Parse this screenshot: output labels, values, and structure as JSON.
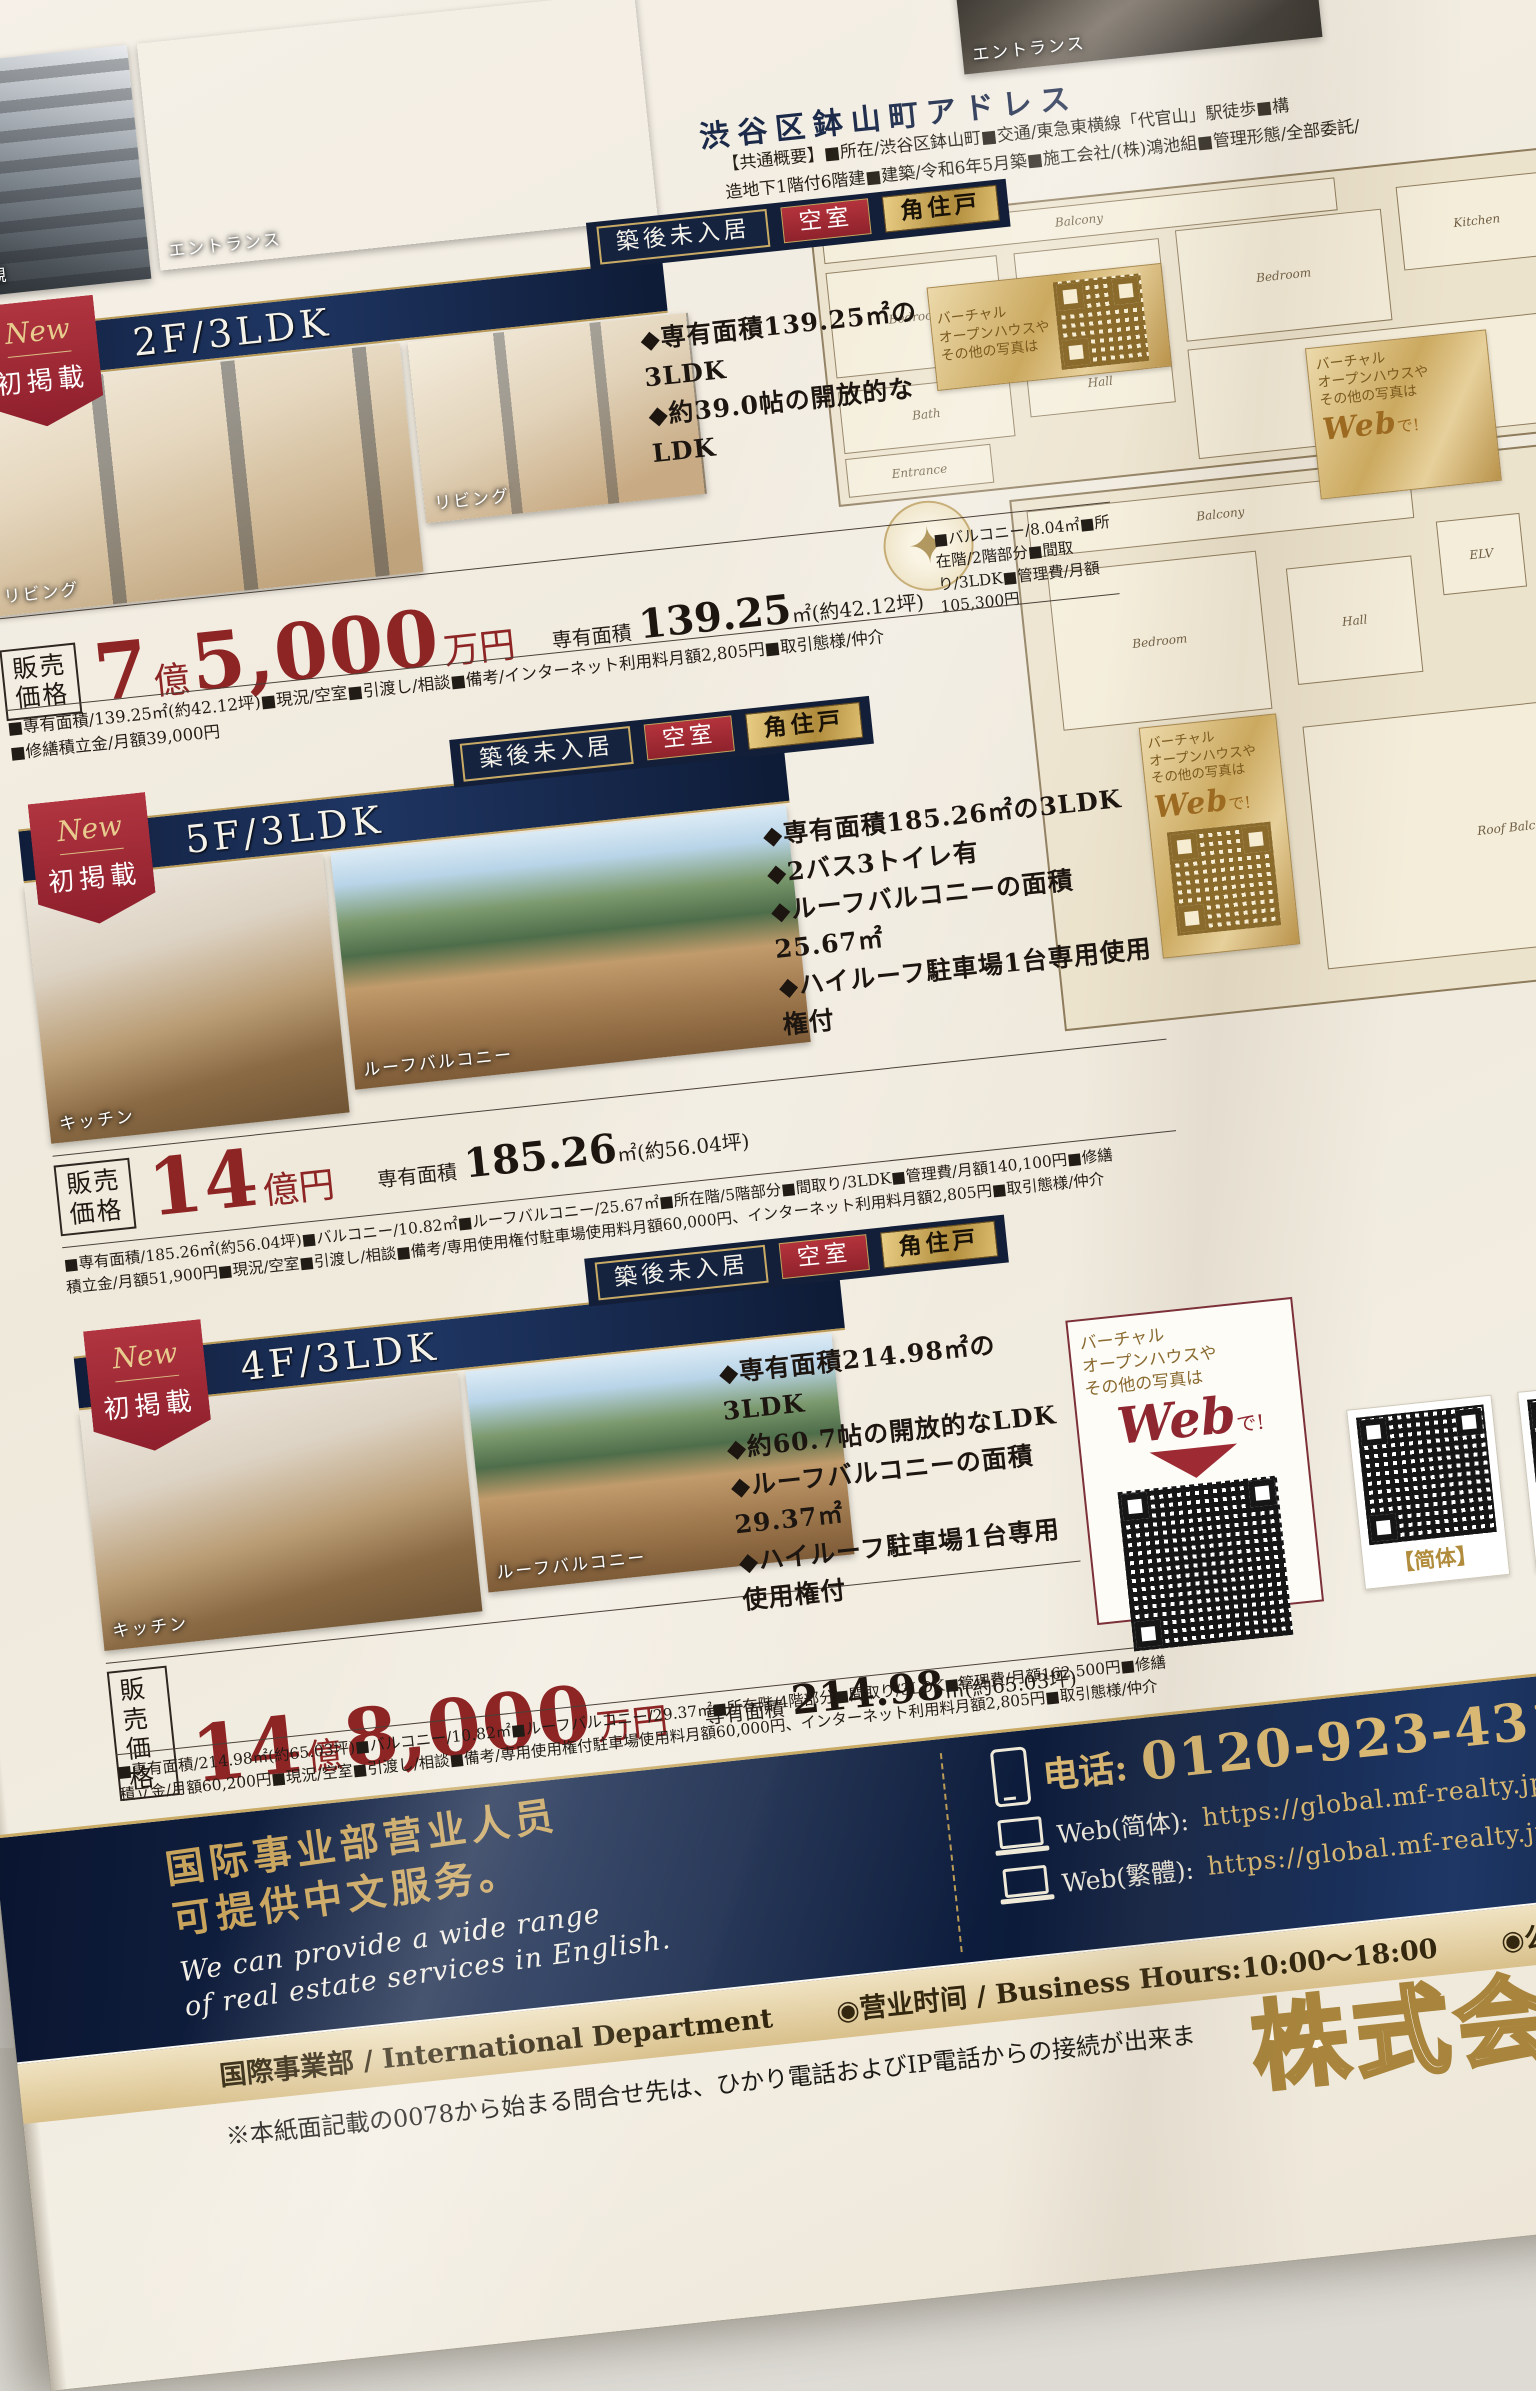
{
  "top_photos": {
    "labels": [
      "外観",
      "エントランス",
      "エントランス"
    ]
  },
  "badges": {
    "built": "築後未入居",
    "vacant": "空室",
    "corner": "角住戸"
  },
  "ribbon": {
    "new": "New",
    "first": "初掲載"
  },
  "web_badge": {
    "line1": "バーチャル",
    "line2": "オープンハウスや",
    "line3": "その他の写真は",
    "web": "Web",
    "de": "で!"
  },
  "building": {
    "title": "渋谷区鉢山町アドレス",
    "overview_lines": [
      "【共通概要】■所在/渋谷区鉢山町■交通/東急東横線「代官山」駅徒歩■構",
      "造地下1階付6階建■建築/令和6年5月築■施工会社/(株)鴻池組■管理形態/全部委託/",
      "理員の勤務形態/日勤"
    ],
    "plan1_rooms": [
      "Balcony",
      "Bedroom",
      "Bedroom",
      "Bedroom",
      "Kitchen",
      "Hall",
      "Bath",
      "Entrance",
      "Living Dining"
    ],
    "plan2_rooms": [
      "Balcony",
      "Bedroom",
      "Hall",
      "ELV",
      "Roof Balcony"
    ]
  },
  "properties": [
    {
      "name": "2F/3LDK",
      "photo_labels": [
        "リビング",
        "リビング"
      ],
      "features": [
        "◆専有面積139.25㎡の3LDK",
        "◆約39.0帖の開放的なLDK"
      ],
      "price_label_1": "販売",
      "price_label_2": "価格",
      "price_main1": "7",
      "price_unit1": "億",
      "price_main2": "5,000",
      "price_unit2": "万円",
      "area_label": "専有面積",
      "area_value": "139.25",
      "area_unit": "㎡(約42.12坪)",
      "spec_side": "■バルコニー/8.04㎡■所在階/2階部分■間取り/3LDK■管理費/月額105,300円",
      "spec_lines": [
        "■専有面積/139.25㎡(約42.12坪)■現況/空室■引渡し/相談■備考/インターネット利用料月額2,805円■取引態様/仲介",
        "■修繕積立金/月額39,000円"
      ]
    },
    {
      "name": "5F/3LDK",
      "photo_labels": [
        "キッチン",
        "ルーフバルコニー"
      ],
      "features": [
        "◆専有面積185.26㎡の3LDK",
        "◆2バス3トイレ有",
        "◆ルーフバルコニーの面積25.67㎡",
        "◆ハイルーフ駐車場1台専用使用権付"
      ],
      "price_label_1": "販売",
      "price_label_2": "価格",
      "price_main1": "14",
      "price_unit1": "億円",
      "price_main2": "",
      "price_unit2": "",
      "area_label": "専有面積",
      "area_value": "185.26",
      "area_unit": "㎡(約56.04坪)",
      "spec_side": "",
      "spec_lines": [
        "■専有面積/185.26㎡(約56.04坪)■バルコニー/10.82㎡■ルーフバルコニー/25.67㎡■所在階/5階部分■間取り/3LDK■管理費/月額140,100円■修繕",
        "積立金/月額51,900円■現況/空室■引渡し/相談■備考/専用使用権付駐車場使用料月額60,000円、インターネット利用料月額2,805円■取引態様/仲介"
      ]
    },
    {
      "name": "4F/3LDK",
      "photo_labels": [
        "キッチン",
        "ルーフバルコニー"
      ],
      "features": [
        "◆専有面積214.98㎡の3LDK",
        "◆約60.7帖の開放的なLDK",
        "◆ルーフバルコニーの面積29.37㎡",
        "◆ハイルーフ駐車場1台専用使用権付"
      ],
      "price_label_1": "販売",
      "price_label_2": "価格",
      "price_main1": "14",
      "price_unit1": "億",
      "price_main2": "8,000",
      "price_unit2": "万円",
      "area_label": "専有面積",
      "area_value": "214.98",
      "area_unit": "㎡(約65.03坪)",
      "spec_side": "",
      "spec_lines": [
        "■専有面積/214.98㎡(約65.03坪)■バルコニー/10.82㎡■ルーフバルコニー/29.37㎡■所在階/4階部分■間取り/3LDK■管理費/月額162,500円■修繕",
        "積立金/月額60,200円■現況/空室■引渡し/相談■備考/専用使用権付駐車場使用料月額60,000円、インターネット利用料月額2,805円■取引態様/仲介"
      ]
    }
  ],
  "footer": {
    "cn_line1": "国际事业部营业人员",
    "cn_line2": "可提供中文服务。",
    "en_line1": "We can provide a wide range",
    "en_line2": "of real estate services in English.",
    "phone_label": "电话:",
    "phone_number": "0120-923-431",
    "web_cn_label": "Web(简体):",
    "web_cn_url": "https://global.mf-realty.jp/cn/",
    "web_tw_label": "Web(繁體):",
    "web_tw_url": "https://global.mf-realty.jp/tc/",
    "qr_cn_label": "【简体】",
    "qr_tw_label": "【繁體】",
    "dept_line": "国際事業部 / International Department",
    "hours_line": "◉营业时间 / Business Hours:10:00〜18:00",
    "holiday_line": "◉公休日 / C",
    "note": "※本紙面記載の0078から始まる問合せ先は、ひかり電話およびIP電話からの接続が出来ま",
    "company_partial": "株式会"
  }
}
